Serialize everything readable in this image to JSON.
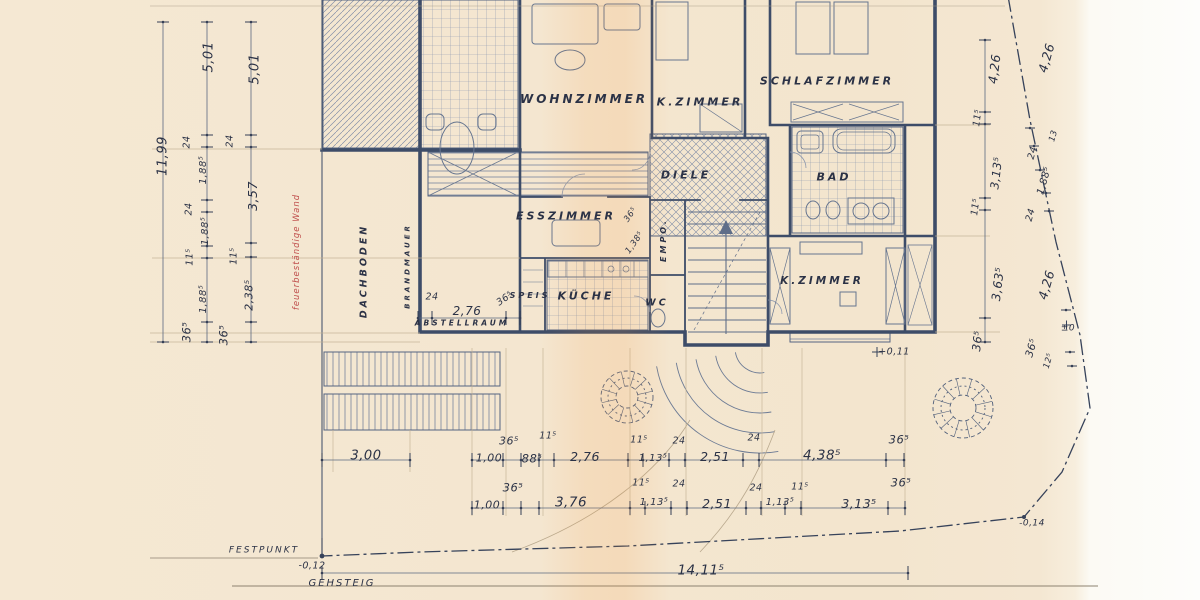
{
  "colors": {
    "paper": "#f4e6d0",
    "paper_edge": "#fdfcf8",
    "ink": "#2b3246",
    "wall_line": "#3d4c68",
    "light_line": "#8a96ad",
    "red_note": "#c0504d",
    "scan_band": "rgba(243,150,60,0.14)"
  },
  "rooms": [
    {
      "t": "WOHNZIMMER",
      "x": 584,
      "y": 99,
      "s": 12,
      "c": "room",
      "n": "room-label-wohnzimmer"
    },
    {
      "t": "K.ZIMMER",
      "x": 700,
      "y": 102,
      "s": 11,
      "c": "room",
      "n": "room-label-kzimmer-top"
    },
    {
      "t": "SCHLAFZIMMER",
      "x": 827,
      "y": 81,
      "s": 11,
      "c": "room",
      "n": "room-label-schlafzimmer"
    },
    {
      "t": "DIELE",
      "x": 686,
      "y": 175,
      "s": 11,
      "c": "room",
      "n": "room-label-diele"
    },
    {
      "t": "BAD",
      "x": 834,
      "y": 177,
      "s": 11,
      "c": "room",
      "n": "room-label-bad"
    },
    {
      "t": "ESSZIMMER",
      "x": 566,
      "y": 216,
      "s": 11,
      "c": "room",
      "n": "room-label-esszimmer"
    },
    {
      "t": "SPEIS",
      "x": 530,
      "y": 296,
      "s": 8,
      "c": "room",
      "n": "room-label-speis"
    },
    {
      "t": "KÜCHE",
      "x": 586,
      "y": 296,
      "s": 11,
      "c": "room",
      "n": "room-label-kueche"
    },
    {
      "t": "WC",
      "x": 657,
      "y": 303,
      "s": 9.5,
      "c": "room",
      "n": "room-label-wc"
    },
    {
      "t": "K.ZIMMER",
      "x": 822,
      "y": 281,
      "s": 10.5,
      "c": "room",
      "n": "room-label-kzimmer-bottom"
    }
  ],
  "annotations": [
    {
      "t": "EMPO.",
      "x": 664,
      "y": 240,
      "r": -90,
      "s": 8,
      "c": "room",
      "n": "room-label-empore"
    },
    {
      "t": "DACHBODEN",
      "x": 364,
      "y": 271,
      "r": -90,
      "s": 9.5,
      "c": "room",
      "n": "room-label-dachboden"
    },
    {
      "t": "BRANDMAUER",
      "x": 408,
      "y": 266,
      "r": -90,
      "s": 7,
      "c": "room",
      "n": "room-label-brandmauer"
    },
    {
      "t": "ABSTELLRAUM",
      "x": 462,
      "y": 323,
      "s": 7.5,
      "c": "room",
      "n": "room-label-abstellraum"
    },
    {
      "t": "feuerbeständige Wand",
      "x": 297,
      "y": 252,
      "r": -90,
      "s": 8.5,
      "c": "red",
      "n": "note-fire-resistant-wall"
    },
    {
      "t": "FESTPUNKT",
      "x": 264,
      "y": 551,
      "s": 9,
      "c": "survey",
      "n": "survey-label-festpunkt"
    },
    {
      "t": "GEHSTEIG",
      "x": 342,
      "y": 584,
      "s": 10,
      "c": "survey",
      "n": "survey-label-gehsteig"
    }
  ],
  "dimensions": {
    "left": [
      {
        "t": "11,99",
        "x": 163,
        "y": 156,
        "r": -90,
        "s": 13
      },
      {
        "t": "5,01",
        "x": 209,
        "y": 57,
        "r": -90,
        "s": 13
      },
      {
        "t": "5,01",
        "x": 255,
        "y": 69,
        "r": -90,
        "s": 13
      },
      {
        "t": "24",
        "x": 187,
        "y": 142,
        "r": -90,
        "s": 9.5
      },
      {
        "t": "24",
        "x": 230,
        "y": 141,
        "r": -90,
        "s": 9.5
      },
      {
        "t": "1,88⁵",
        "x": 204,
        "y": 170,
        "r": -90,
        "s": 10
      },
      {
        "t": "3,57",
        "x": 253,
        "y": 196,
        "r": -90,
        "s": 12.5
      },
      {
        "t": "24",
        "x": 189,
        "y": 209,
        "r": -90,
        "s": 9.5
      },
      {
        "t": "1,88⁵",
        "x": 206,
        "y": 231,
        "r": -90,
        "s": 10
      },
      {
        "t": "11⁵",
        "x": 190,
        "y": 257,
        "r": -90,
        "s": 9.5
      },
      {
        "t": "11⁵",
        "x": 234,
        "y": 256,
        "r": -90,
        "s": 9.5
      },
      {
        "t": "1,88⁵",
        "x": 204,
        "y": 299,
        "r": -90,
        "s": 10
      },
      {
        "t": "2,38⁵",
        "x": 249,
        "y": 295,
        "r": -90,
        "s": 11
      },
      {
        "t": "36⁵",
        "x": 187,
        "y": 332,
        "r": -90,
        "s": 11.5
      },
      {
        "t": "36⁵",
        "x": 224,
        "y": 335,
        "r": -90,
        "s": 11.5
      }
    ],
    "right": [
      {
        "t": "4,26",
        "x": 995,
        "y": 69,
        "r": -83,
        "s": 12.5
      },
      {
        "t": "4,26",
        "x": 1047,
        "y": 58,
        "r": -74,
        "s": 12.5
      },
      {
        "t": "11⁵",
        "x": 978,
        "y": 118,
        "r": -83,
        "s": 9.5
      },
      {
        "t": "13",
        "x": 1054,
        "y": 136,
        "r": -74,
        "s": 8.5
      },
      {
        "t": "24",
        "x": 1033,
        "y": 153,
        "r": -74,
        "s": 9.5
      },
      {
        "t": "3,13⁵",
        "x": 997,
        "y": 173,
        "r": -83,
        "s": 11.5
      },
      {
        "t": "1,88⁵",
        "x": 1045,
        "y": 181,
        "r": -74,
        "s": 10
      },
      {
        "t": "11⁵",
        "x": 976,
        "y": 207,
        "r": -83,
        "s": 9.5
      },
      {
        "t": "24",
        "x": 1031,
        "y": 215,
        "r": -74,
        "s": 9.5
      },
      {
        "t": "3,63⁵",
        "x": 998,
        "y": 284,
        "r": -83,
        "s": 12
      },
      {
        "t": "4,26",
        "x": 1047,
        "y": 285,
        "r": -74,
        "s": 12.5
      },
      {
        "t": "36⁵",
        "x": 978,
        "y": 341,
        "r": -83,
        "s": 11.5
      },
      {
        "t": "36⁵",
        "x": 1032,
        "y": 348,
        "r": -74,
        "s": 10.5
      },
      {
        "t": "12⁵",
        "x": 1049,
        "y": 361,
        "r": -74,
        "s": 8.5
      },
      {
        "t": "±0",
        "x": 1068,
        "y": 329,
        "s": 9
      }
    ],
    "bottom_row1": [
      {
        "t": "3,00",
        "x": 366,
        "y": 456,
        "s": 13
      },
      {
        "t": "1,00",
        "x": 489,
        "y": 458,
        "s": 11
      },
      {
        "t": "36⁵",
        "x": 509,
        "y": 441,
        "s": 11
      },
      {
        "t": "88⁵",
        "x": 532,
        "y": 459,
        "s": 11.5
      },
      {
        "t": "11⁵",
        "x": 548,
        "y": 436,
        "s": 9.5
      },
      {
        "t": "2,76",
        "x": 585,
        "y": 457,
        "s": 12.5
      },
      {
        "t": "11⁵",
        "x": 639,
        "y": 440,
        "s": 9.5
      },
      {
        "t": "1,13⁵",
        "x": 653,
        "y": 459,
        "s": 10
      },
      {
        "t": "24",
        "x": 679,
        "y": 441,
        "s": 9.5
      },
      {
        "t": "2,51",
        "x": 715,
        "y": 457,
        "s": 12.5
      },
      {
        "t": "24",
        "x": 754,
        "y": 438,
        "s": 9.5
      },
      {
        "t": "4,38⁵",
        "x": 822,
        "y": 456,
        "s": 13.5
      },
      {
        "t": "36⁵",
        "x": 899,
        "y": 440,
        "s": 11.5
      }
    ],
    "bottom_row2": [
      {
        "t": "36⁵",
        "x": 513,
        "y": 488,
        "s": 11.5
      },
      {
        "t": "1,00",
        "x": 487,
        "y": 505,
        "s": 11
      },
      {
        "t": "3,76",
        "x": 571,
        "y": 503,
        "s": 13.5
      },
      {
        "t": "11⁵",
        "x": 641,
        "y": 483,
        "s": 9.5
      },
      {
        "t": "1,13⁵",
        "x": 654,
        "y": 503,
        "s": 10
      },
      {
        "t": "24",
        "x": 679,
        "y": 484,
        "s": 9.5
      },
      {
        "t": "2,51",
        "x": 717,
        "y": 504,
        "s": 12.5
      },
      {
        "t": "24",
        "x": 756,
        "y": 488,
        "s": 9.5
      },
      {
        "t": "1,13⁵",
        "x": 780,
        "y": 503,
        "s": 10
      },
      {
        "t": "11⁵",
        "x": 800,
        "y": 487,
        "s": 9.5
      },
      {
        "t": "3,13⁵",
        "x": 859,
        "y": 504,
        "s": 12.5
      },
      {
        "t": "36⁵",
        "x": 901,
        "y": 483,
        "s": 11.5
      }
    ],
    "inline": [
      {
        "t": "24",
        "x": 432,
        "y": 297,
        "s": 9.5
      },
      {
        "t": "2,76",
        "x": 467,
        "y": 311,
        "s": 12
      },
      {
        "t": "36⁵",
        "x": 505,
        "y": 299,
        "r": -35,
        "s": 9.5
      },
      {
        "t": "36⁵",
        "x": 631,
        "y": 215,
        "r": -55,
        "s": 8.5
      },
      {
        "t": "1,38⁵",
        "x": 635,
        "y": 243,
        "r": -55,
        "s": 8.5
      },
      {
        "t": "+0,11",
        "x": 894,
        "y": 352,
        "s": 9.5
      }
    ],
    "survey": [
      {
        "t": "-0,12",
        "x": 312,
        "y": 566,
        "s": 9.5
      },
      {
        "t": "14,11⁵",
        "x": 701,
        "y": 571,
        "s": 13.5
      },
      {
        "t": "-0,14",
        "x": 1032,
        "y": 524,
        "s": 9
      }
    ]
  }
}
